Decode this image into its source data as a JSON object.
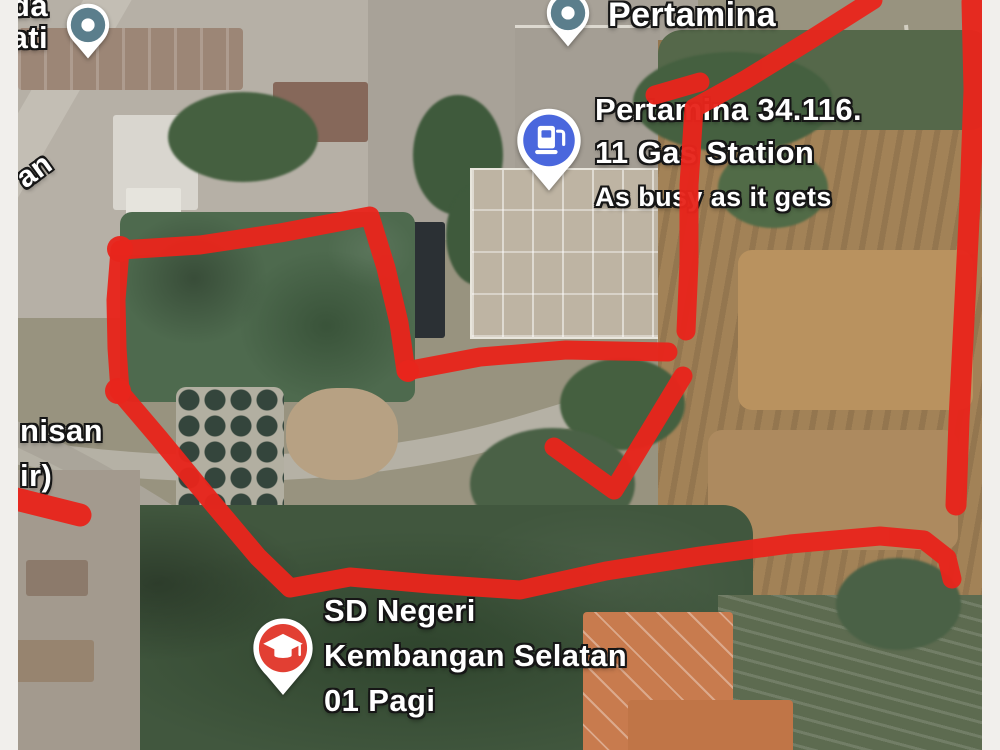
{
  "map": {
    "colors": {
      "annotation_red": "#e8251c",
      "poi_pin_teal": "#5b7e8c",
      "gas_pin_blue": "#4a67dd",
      "school_pin_red": "#e23f33",
      "label_text": "#ffffff"
    },
    "labels": {
      "top_left_partial_line1": "da",
      "top_left_partial_line2": "ati",
      "road_name_partial": "an",
      "poi_title": "Pertamina",
      "gas_title_line1": "Pertamina 34.116.",
      "gas_title_line2": "11 Gas Station",
      "gas_subtitle": "As busy as it gets",
      "left_partial_line1": "nisan",
      "left_partial_line2": "ir)",
      "school_line1": "SD Negeri",
      "school_line2": "Kembangan Selatan",
      "school_line3": "01 Pagi"
    }
  }
}
